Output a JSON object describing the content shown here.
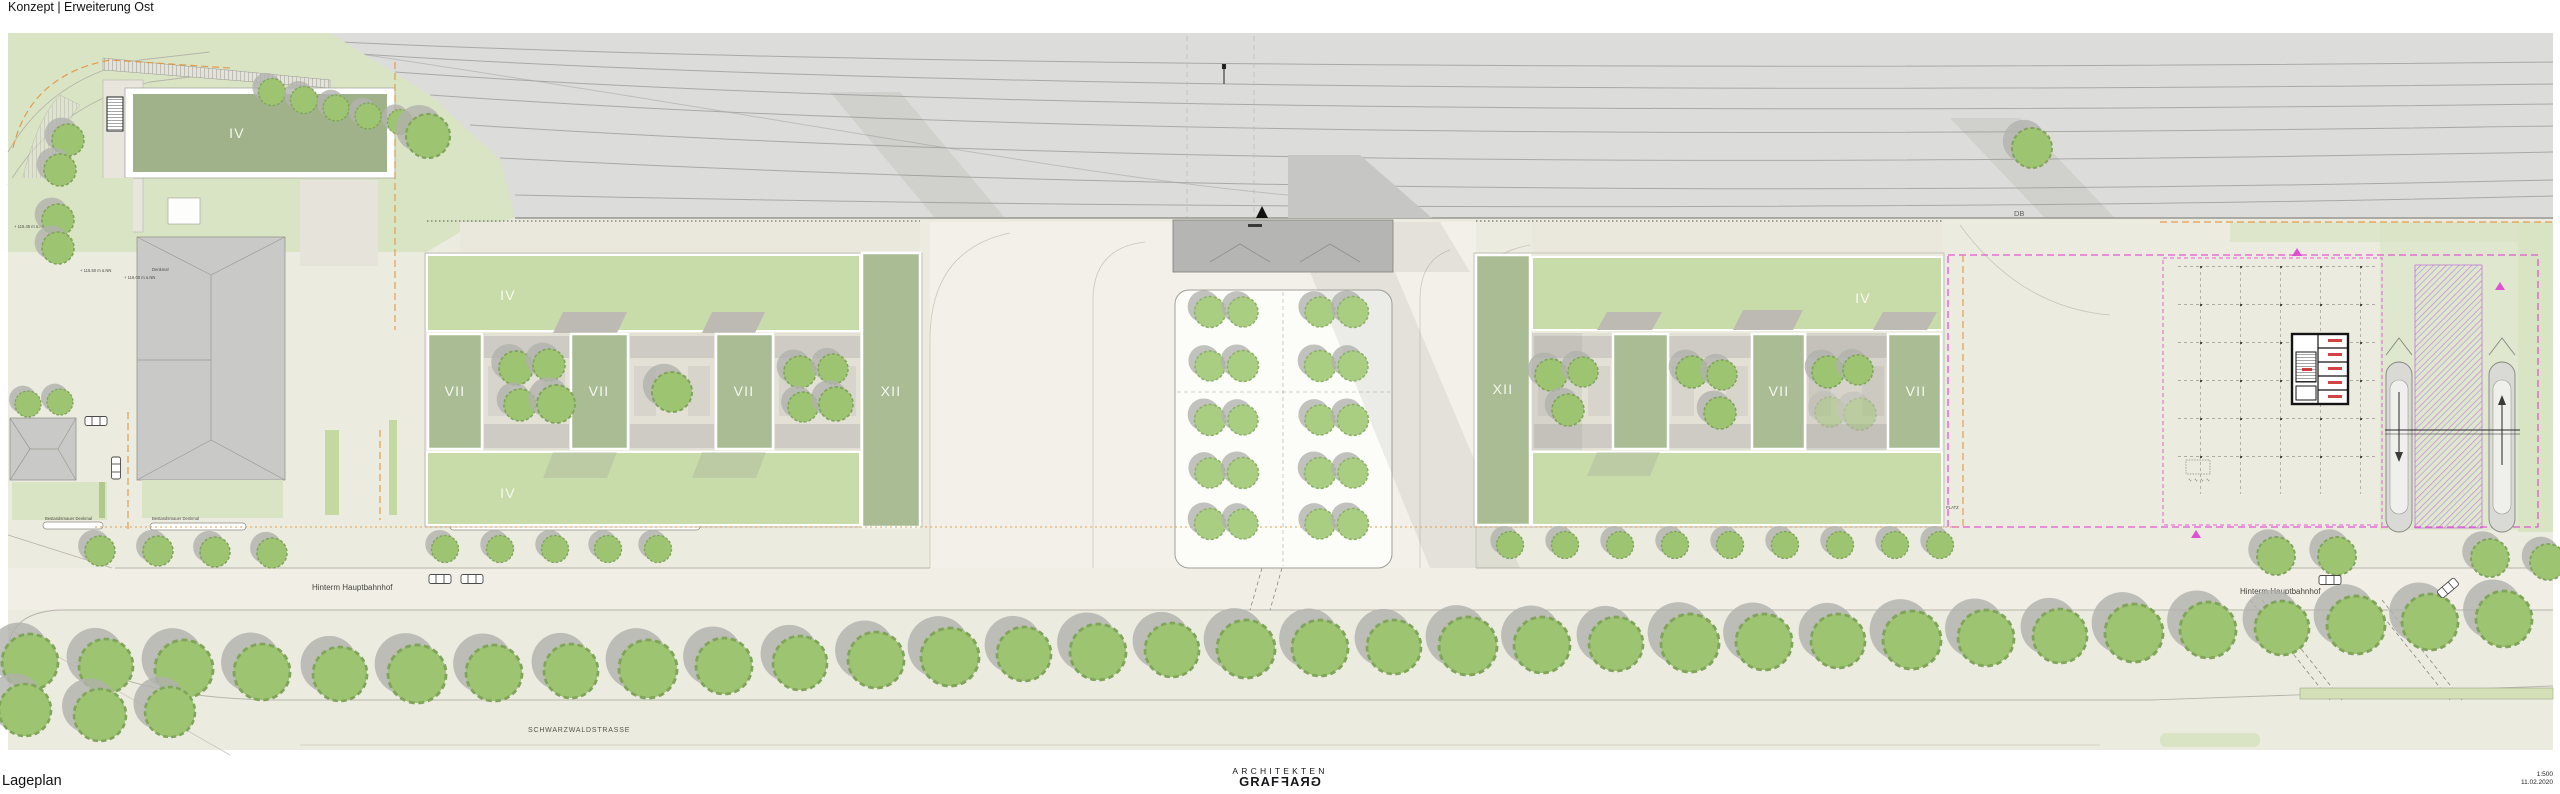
{
  "header": {
    "title": "Konzept | Erweiterung Ost"
  },
  "footer": {
    "drawing_name": "Lageplan",
    "logo_line1": "ARCHITEKTEN",
    "logo_word": "GRAF",
    "scale": "1:500",
    "date": "11.02.2020"
  },
  "plan": {
    "railway_label": "DB",
    "streets": {
      "hinterm_hauptbahnhof": "Hinterm Hauptbahnhof",
      "schwarzwaldstrasse": "SCHWARZWALDSTRASSE"
    },
    "building_labels": {
      "iv": "IV",
      "vii": "VII",
      "xii": "XII"
    },
    "annotations": {
      "bestandsmauer": "Bestandsmauer Denkmal",
      "denkmal": "Denkmal",
      "platz": "PLATZ",
      "elev_115_45": "+ 115.45 m ü.NN",
      "elev_115_50": "+ 115.50 m ü.NN",
      "elev_116_00": "+ 116.00 m ü.NN"
    },
    "colors": {
      "canvas": "#ecebe0",
      "rail": "#dcdcda",
      "railline": "#a9a9a7",
      "lawn": "#d9e4c4",
      "band": "#c8dcaa",
      "sage": "#a9bc93",
      "roofdark": "#9fb28a",
      "roof": "#c9c9c7",
      "tree": "#9cc471",
      "treelight": "#a9ce81",
      "treeshadow": "#b2b2ae",
      "structure": "#b5b5b3",
      "magenta": "#e03fd0",
      "orange": "#e2953f"
    }
  }
}
